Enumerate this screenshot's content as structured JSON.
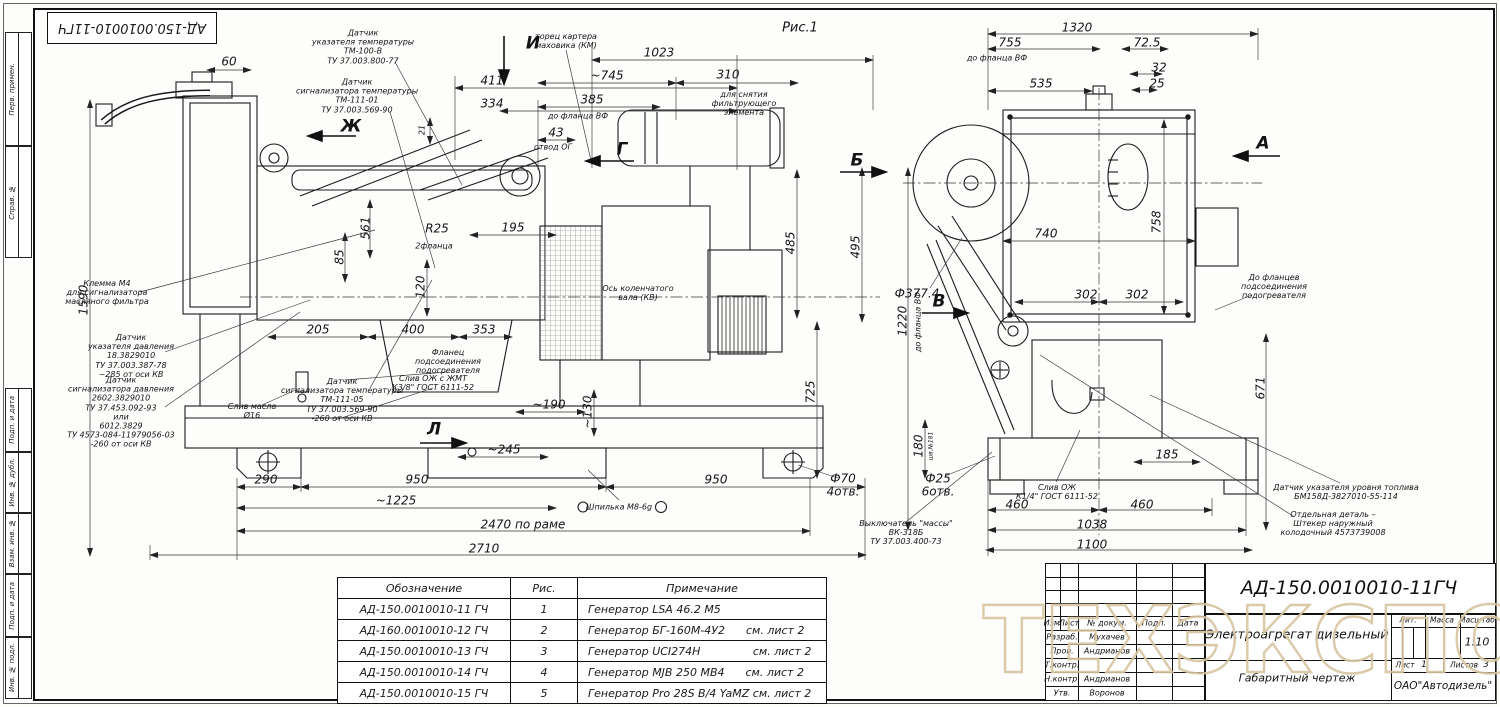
{
  "sheet": {
    "stamp": "АД-150.0010010-11ГЧ",
    "fig_label": "Рис.1",
    "margins": [
      "Перв. примен.",
      "Справ. №",
      "Подп. и дата",
      "Инв. № дубл.",
      "Взам. инв. №",
      "Подп. и дата",
      "Инв. № подл."
    ]
  },
  "view_arrows": {
    "i": "И",
    "zh": "Ж",
    "g": "Г",
    "b": "Б",
    "l": "Л",
    "v": "В",
    "a": "А"
  },
  "left": {
    "dims": {
      "d60": "60",
      "d1590": "1590",
      "d21": "21",
      "d411": "411",
      "d334": "334",
      "d385": "385",
      "lbl_flange": "до фланца ВФ",
      "d43": "43",
      "lbl_otvod": "отвод ОГ",
      "d1023": "1023",
      "d745": "~745",
      "d310": "310",
      "d561": "561",
      "r25": "R25",
      "d195": "195",
      "lbl_2fl": "2фланца",
      "d85": "85",
      "d120": "120",
      "d205": "205",
      "d400": "400",
      "d353": "353",
      "d495": "495",
      "d485": "485",
      "d725": "725",
      "d190": "~190",
      "d130": "~130",
      "d245": "~245",
      "d290": "290",
      "d950a": "950",
      "d950b": "950",
      "d1225": "~1225",
      "d2470": "2470 по раме",
      "d2710": "2710",
      "f70": "Ф70\n4отв."
    },
    "callouts": {
      "temp_gauge": "Датчик\nуказателя температуры\nТМ-100-В\nТУ 37.003.800-77",
      "temp_sig1": "Датчик\nсигнализатора температуры\nТМ-111-01\nТУ 37.003.569-90",
      "flywheel": "торец картера\nмаховика (КМ)",
      "filter": "для снятия\nфильтрующего\nэлемента",
      "klemma": "Клемма М4\nдля сигнализатора\nмасляного фильтра",
      "press_gauge": "Датчик\nуказателя давления\n18.3829010\nТУ 37.003.387-78\n~285 от оси КВ",
      "press_sig": "Датчик\nсигнализатора давления\n2602.3829010\nТУ 37.453.092-93\nили\n6012.3829\nТУ 4573-084-11979056-03\n-260 от оси КВ",
      "oil_drain": "Слив масла\nØ16",
      "temp_sig2": "Датчик\nсигнализатора температуры\nТМ-111-05\nТУ 37.003.569-90\n-260 от оси КВ",
      "heater_flange": "Фланец\nподсоединения\nподогревателя",
      "cool_drain": "Слив ОЖ с ЖМТ\nК3/8\" ГОСТ 6111-52",
      "crank_axis": "Ось коленчатого\nвала (КВ)",
      "stud": "Шпилька М8-6g"
    }
  },
  "right": {
    "dims": {
      "d1320": "1320",
      "d755": "755",
      "lbl_flange": "до фланца ВФ",
      "d535": "535",
      "d72": "72.5",
      "d32": "32",
      "d25": "25",
      "d740": "740",
      "d758": "758",
      "d302a": "302",
      "d302b": "302",
      "f377": "Ф377.4",
      "d1220": "1220",
      "lbl_flange_v": "до фланца ВФ",
      "d671": "671",
      "d180": "180",
      "lbl_shl": "шв.№181",
      "f25": "Ф25\n6отв.",
      "d185": "185",
      "d460a": "460",
      "d460b": "460",
      "d1038": "1038",
      "d1100": "1100"
    },
    "callouts": {
      "heater_flanges": "До фланцев\nподсоединения\nподогревателя",
      "cool_drain": "Слив ОЖ\nК1/4\" ГОСТ 6111-52",
      "fuel_sensor": "Датчик указателя уровня топлива\nБМ158Д-3827010-55-114",
      "plug": "Отдельная деталь –\nШтекер наружный\nколодочный 4573739008",
      "mass_switch": "Выключатель \"массы\"\nВК-318Б\nТУ 37.003.400-73"
    }
  },
  "table": {
    "headers": [
      "Обозначение",
      "Рис.",
      "Примечание"
    ],
    "rows": [
      [
        "АД-150.0010010-11 ГЧ",
        "1",
        "Генератор LSA 46.2 M5"
      ],
      [
        "АД-160.0010010-12 ГЧ",
        "2",
        "Генератор БГ-160М-4У2      см. лист 2"
      ],
      [
        "АД-150.0010010-13 ГЧ",
        "3",
        "Генератор UCI274H               см. лист 2"
      ],
      [
        "АД-150.0010010-14 ГЧ",
        "4",
        "Генератор MJB 250 MB4      см. лист 2"
      ],
      [
        "АД-150.0010010-15 ГЧ",
        "5",
        "Генератор Pro 28S B/4 YaMZ см. лист 2"
      ]
    ]
  },
  "title_block": {
    "doc_number": "АД-150.0010010-11ГЧ",
    "cols": [
      "Изм.",
      "Лист",
      "№ докум.",
      "Подп.",
      "Дата"
    ],
    "rows": [
      {
        "role": "Разраб.",
        "name": "Мухачев"
      },
      {
        "role": "Пров.",
        "name": "Андрианов"
      },
      {
        "role": "Т.контр.",
        "name": ""
      },
      {
        "role": "Н.контр.",
        "name": "Андрианов"
      },
      {
        "role": "Утв.",
        "name": "Воронов"
      }
    ],
    "product_title": "Электроагрегат дизельный",
    "doc_type": "Габаритный чертеж",
    "lit_label": "Лит.",
    "mass_label": "Масса",
    "scale_label": "Масштаб",
    "scale": "1:10",
    "sheet_label": "Лист",
    "sheet_no": "1",
    "sheets_label": "Листов",
    "sheets_total": "3",
    "company": "ОАО\"Автодизель\""
  },
  "watermark": {
    "text": "ТЕХЭКСПО",
    "reg": "®",
    "color": "#d8c5a0"
  }
}
